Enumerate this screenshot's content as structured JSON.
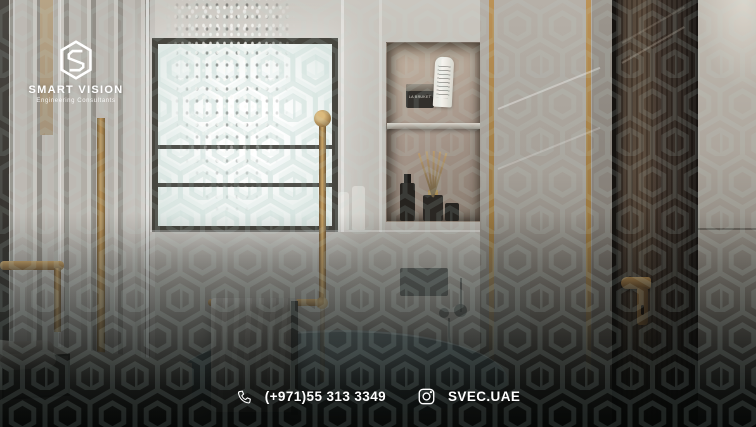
{
  "brand": {
    "name": "SMART VISION",
    "tagline": "Engineering Consultants",
    "logo_icon": "hexagon-s-logo"
  },
  "contact": {
    "phone": "(+971)55 313 3349",
    "phone_icon": "phone-icon",
    "instagram_handle": "SVEC.UAE",
    "instagram_icon": "instagram-icon"
  },
  "scene": {
    "description": "3D interior render of a luxury bathroom: marble walls, glass shower with falling water, patterned window, brass fixtures, wall niche with toiletries, freestanding tub with towel, dark wooden door",
    "niche_products": {
      "jar_label": "LA BRUKET"
    }
  },
  "colors": {
    "accent_gold": "#b08d55",
    "marble_light": "#c6c2bb",
    "wood_dark": "#3a2f27",
    "pattern_teal": "#c3dcd6",
    "overlay_dark": "#0b0d0c",
    "text_white": "#ffffff"
  }
}
